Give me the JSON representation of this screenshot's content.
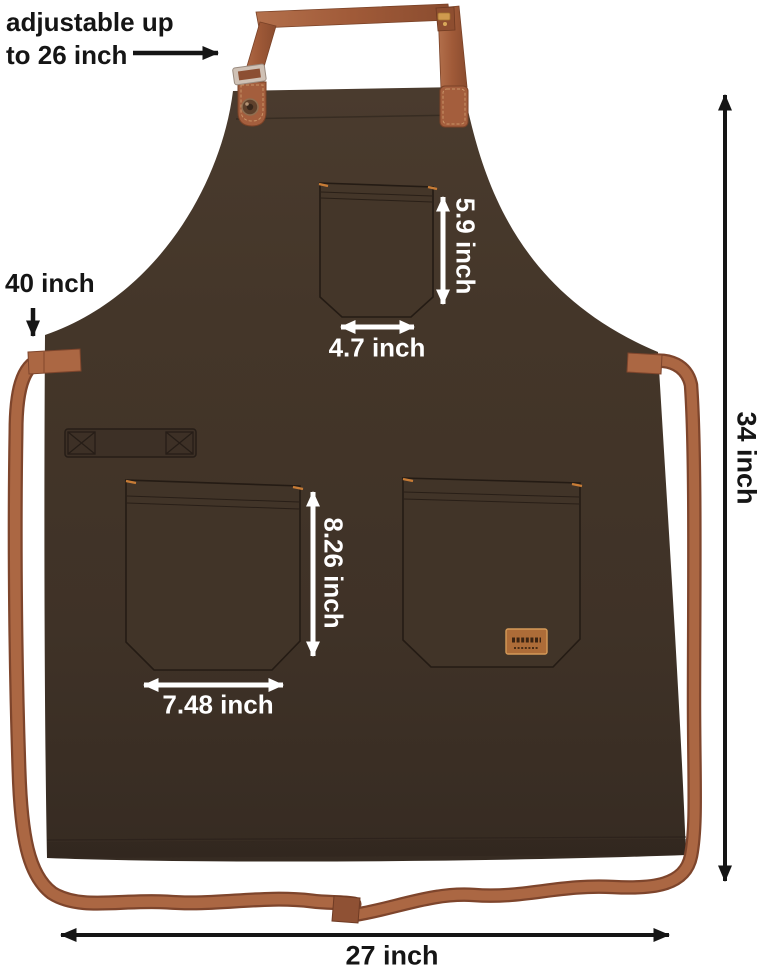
{
  "figure": {
    "type": "product-dimension-diagram",
    "subject": "bib apron with chest pocket, two front pockets, towel loop, adjustable neck strap and long waist straps"
  },
  "colors": {
    "background": "#ffffff",
    "apron_body": "#42352a",
    "apron_outline": "#231a13",
    "strap": "#a7613f",
    "strap_shadow": "#7e452c",
    "metal_buckle": "#cfc1b5",
    "brand_tag": "#ad6c38",
    "corner_stitch": "#c87c36",
    "annotation_black": "#151515",
    "annotation_white": "#ffffff"
  },
  "annotations": {
    "neck_adjustable": {
      "line1": "adjustable up",
      "line2": "to 26 inch"
    },
    "waist_strap": {
      "label": "40 inch"
    },
    "chest_pocket_height": {
      "label": "5.9 inch"
    },
    "chest_pocket_width": {
      "label": "4.7 inch"
    },
    "front_pocket_height": {
      "label": "8.26 inch"
    },
    "front_pocket_width": {
      "label": "7.48 inch"
    },
    "apron_length": {
      "label": "34 inch"
    },
    "apron_width": {
      "label": "27 inch"
    }
  }
}
